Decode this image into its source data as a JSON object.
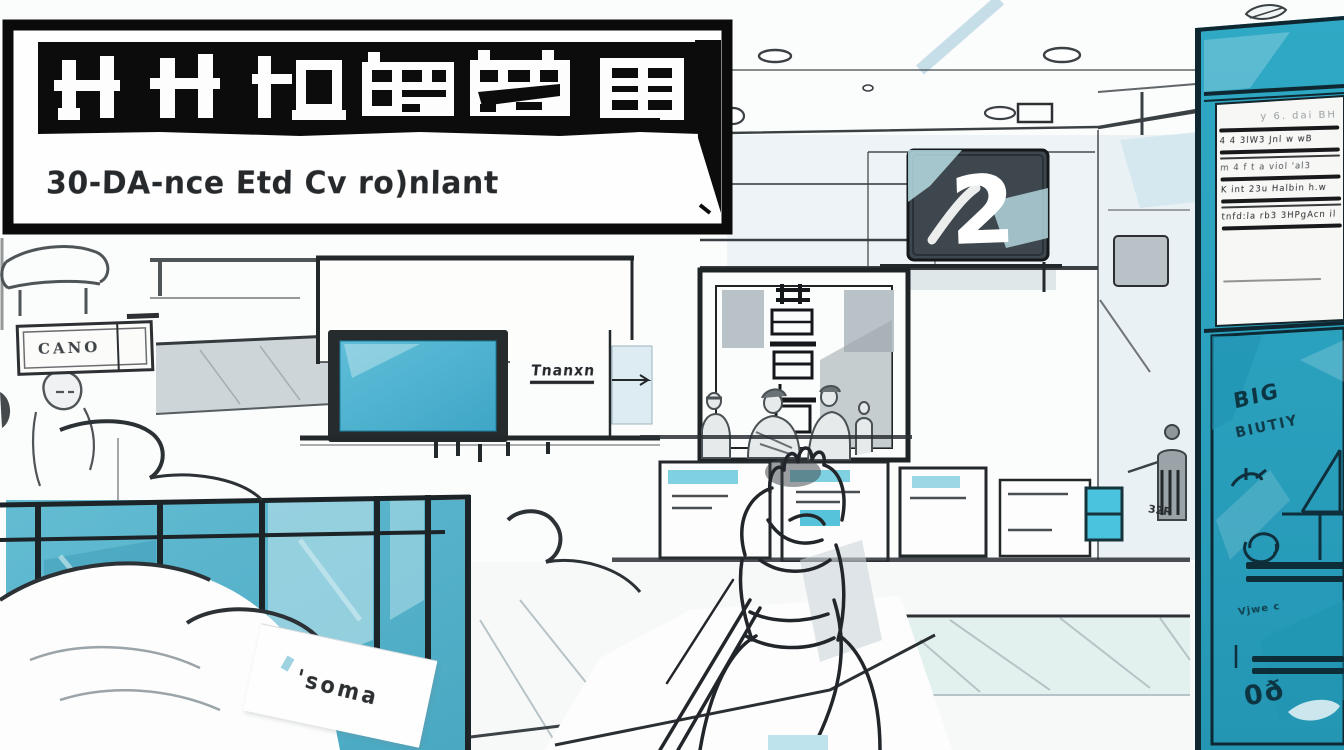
{
  "colors": {
    "teal_screen": "#4db2cf",
    "glass_teal": "#57b3cb",
    "kiosk_teal": "#2ba4c0",
    "ink": "#1d2226",
    "sign_dark": "#3e474d",
    "accent_cyan": "#bfe6ee"
  },
  "banner": {
    "logotype_alt": "卄卄打拴实施",
    "subtitle": "30-DA-nce Etd Cv ro)nlant"
  },
  "wall": {
    "counter_number": "2"
  },
  "left": {
    "plaque": "CANO",
    "teller_label": "Tnanxn",
    "note_card": "'soma"
  },
  "floor": {
    "mark": "32R"
  },
  "kiosk": {
    "notice_header": "y 6. dai BH",
    "notice_lines": [
      "4 4  3lW3 Jnl w wB",
      "m 4   f t a viol  'al3",
      "K int 23u Halbin h.w",
      "tnfd:la rb3 3HPgAcn il"
    ],
    "panel_word_1": "BIG",
    "panel_word_2": "BIUTIY",
    "panel_note": "Vjwe c",
    "panel_mark": "0ð"
  }
}
